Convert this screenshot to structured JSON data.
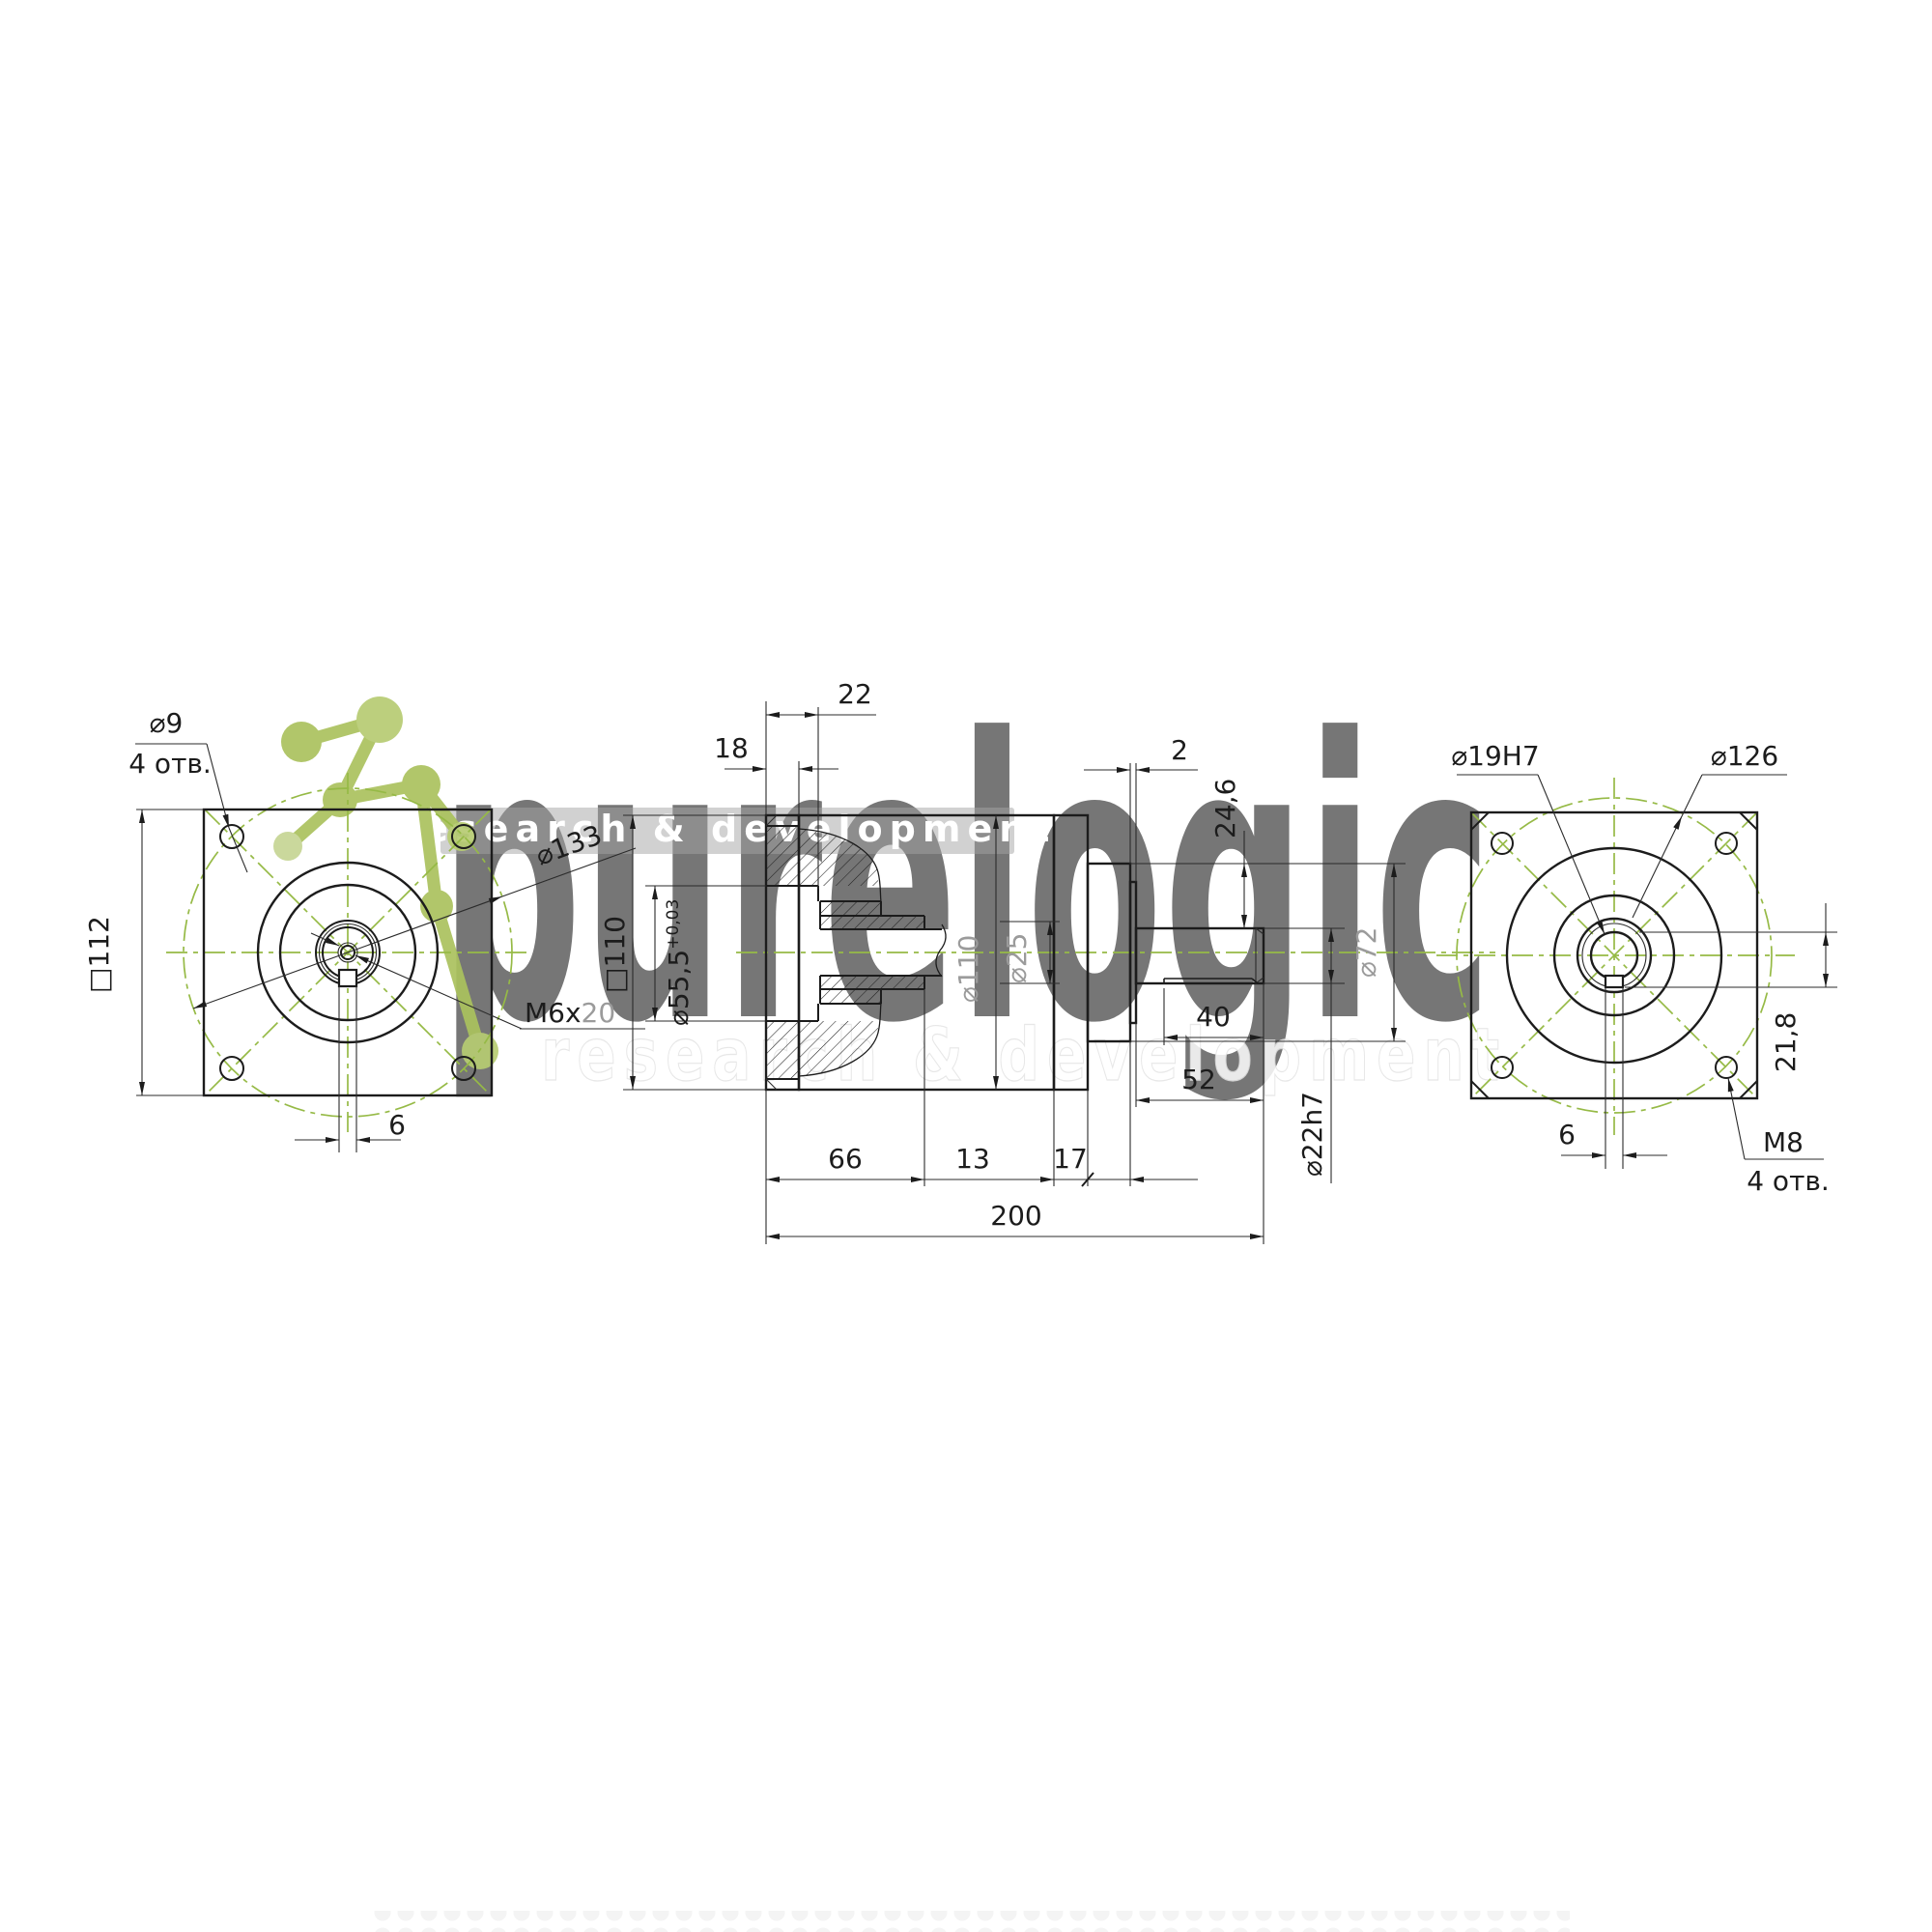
{
  "colors": {
    "line": "#1c1c1c",
    "dimension": "#2b2b2b",
    "centerline_green": "#96ba46",
    "gray_label": "#9b9b9b",
    "molecule_green": "#abc25e",
    "background": "#ffffff"
  },
  "watermark": {
    "brand": "purelogic",
    "tagline_small": "research & development",
    "tagline_large": "research & development"
  },
  "left_view": {
    "hole_dia": "⌀9",
    "hole_count": "4 отв.",
    "bolt_circle": "⌀133",
    "flange_square": "□112",
    "thread_label": "M6x",
    "thread_depth": "20",
    "keyway_width": "6"
  },
  "middle_view": {
    "flange_thickness": "18",
    "pilot_depth": "22",
    "flange_square": "□110",
    "pilot_dia": "⌀55,5",
    "pilot_tol": "+0,03",
    "body_dia": "⌀110",
    "bore_dia": "⌀25",
    "lip": "2",
    "shoulder": "24,6",
    "collar_dia": "⌀72",
    "shaft_dia": "⌀22h7",
    "keyway_length": "40",
    "shaft_length": "52",
    "hub_length": "66",
    "plate_thickness": "13",
    "collar_length": "17",
    "total_length": "200"
  },
  "right_view": {
    "bore_dia": "⌀19H7",
    "bolt_circle": "⌀126",
    "keyway_depth": "21,8",
    "keyway_width": "6",
    "thread": "M8",
    "hole_count": "4 отв."
  }
}
